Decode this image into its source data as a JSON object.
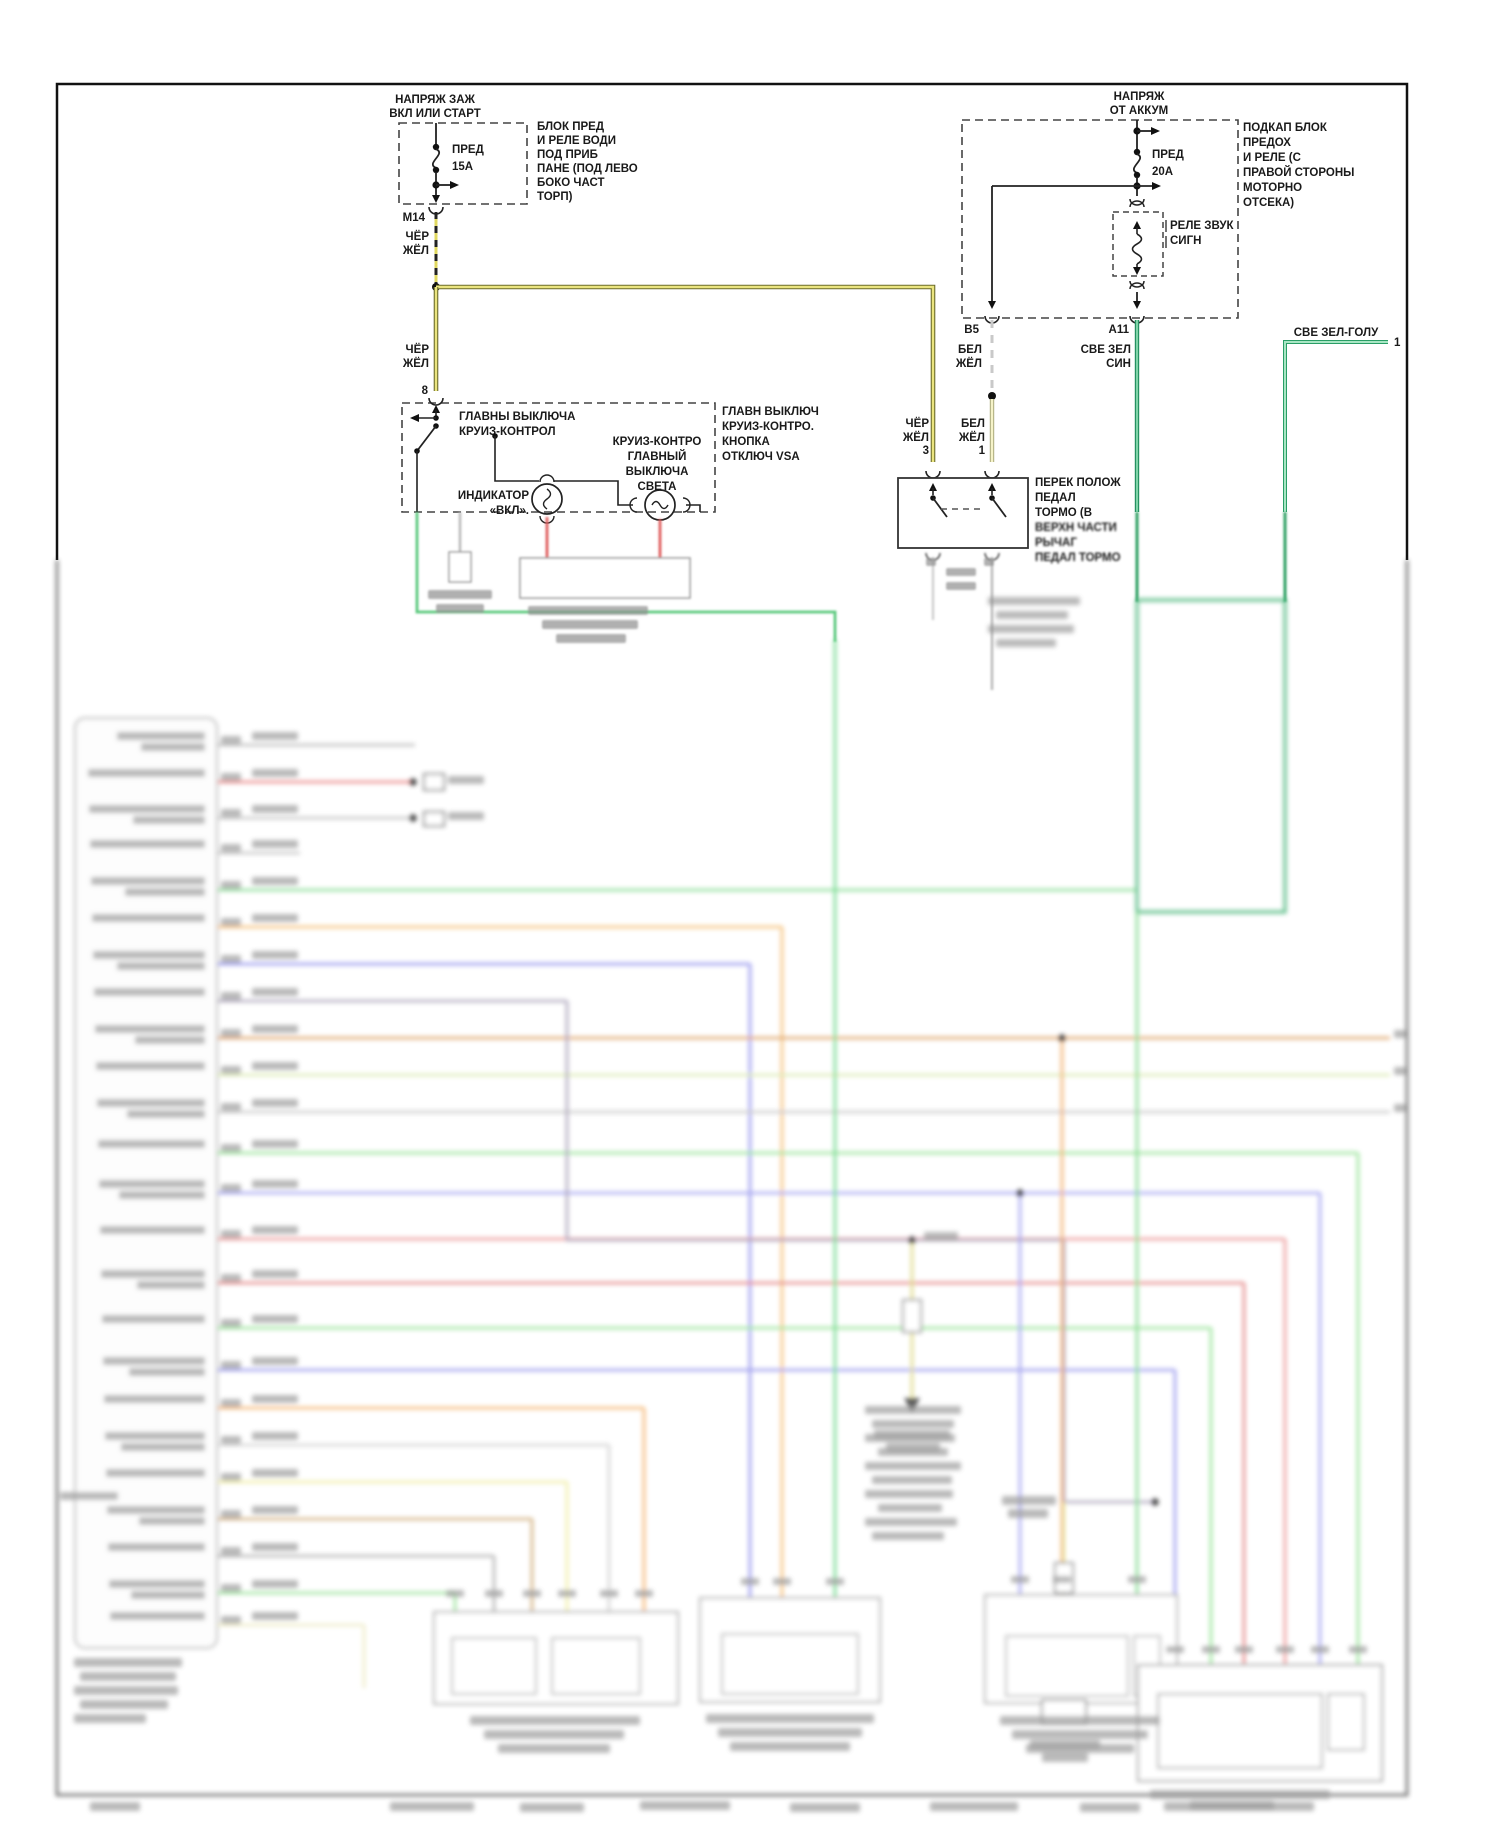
{
  "palette": {
    "line_dark": "#2b2b2b",
    "cher_zhel_edge": "#6b6b2a",
    "cher_zhel_core": "#eae47f",
    "bel_zhel_edge": "#a8a87a",
    "bel_zhel_core": "#f6f3c8",
    "green_edge": "#1c8a5a",
    "green_core": "#7fd4a8",
    "blob_gray": "#8f8f8f"
  },
  "header": {
    "ignition": {
      "l1": "НАПРЯЖ ЗАЖ",
      "l2": "ВКЛ ИЛИ СТАРТ"
    },
    "battery": {
      "l1": "НАПРЯЖ",
      "l2": "ОТ АККУМ"
    }
  },
  "fuse_box_left": {
    "fuse": "ПРЕД",
    "rating": "15A",
    "desc": [
      "БЛОК ПРЕД",
      "И РЕЛЕ ВОДИ",
      "ПОД ПРИБ",
      "ПАНЕ (ПОД ЛЕВО",
      "БОКО ЧАСТ",
      "ТОРП)"
    ],
    "connector": "М14"
  },
  "fuse_box_right": {
    "fuse": "ПРЕД",
    "rating": "20A",
    "desc": [
      "ПОДКАП БЛОК",
      "ПРЕДОХ",
      "И РЕЛЕ (С",
      "ПРАВОЙ СТОРОНЫ",
      "МОТОРНО",
      "ОТСЕКА)"
    ],
    "relay1": "РЕЛЕ ЗВУК",
    "relay2": "СИГН",
    "b5": "B5",
    "a11": "A11"
  },
  "wire_labels": {
    "cher": "ЧЁР",
    "zhel": "ЖЁЛ",
    "bel": "БЕЛ",
    "sve_zel": "СВЕ ЗЕЛ",
    "sin": "СИН",
    "sve_zel_golu": "СВЕ ЗЕЛ-ГОЛУ",
    "pin8": "8",
    "pin3": "3",
    "pin1": "1",
    "pin1_right": "1"
  },
  "cruise_switch": {
    "title1": "ГЛАВНЫ ВЫКЛЮЧА",
    "title2": "КРУИЗ-КОНТРОЛ",
    "ind1": "ИНДИКАТОР",
    "ind2": "«ВКЛ».",
    "lamp1": "КРУИЗ-КОНТРО",
    "lamp2": "ГЛАВНЫЙ",
    "lamp3": "ВЫКЛЮЧА",
    "lamp4": "СВЕТА",
    "note1": "ГЛАВН ВЫКЛЮЧ",
    "note2": "КРУИЗ-КОНТРО.",
    "note3": "КНОПКА",
    "note4": "ОТКЛЮЧ VSA"
  },
  "pedal_switch": {
    "d1": "ПЕРЕК ПОЛОЖ",
    "d2": "ПЕДАЛ",
    "d3": "ТОРМО (В",
    "d4": "ВЕРХН ЧАСТИ",
    "d5": "РЫЧАГ",
    "d6": "ПЕДАЛ ТОРМО"
  },
  "blur_section": {
    "note": "lower half of scan is out of focus; text illegible",
    "block": {
      "x": 75,
      "y": 718,
      "w": 142,
      "h": 930
    },
    "rows": [
      {
        "y": 745,
        "c": "#b5b5b5",
        "x2": 415
      },
      {
        "y": 782,
        "c": "#e87a7a",
        "x2": 413,
        "dot": 1
      },
      {
        "y": 818,
        "c": "#bdbdbd",
        "x2": 413,
        "dot": 1
      },
      {
        "y": 853,
        "c": "#bdbdbd",
        "x2": 300
      },
      {
        "y": 890,
        "c": "#7ed98c",
        "x2": 1136
      },
      {
        "y": 927,
        "c": "#f4b96a",
        "x2": 782,
        "drop": 1598
      },
      {
        "y": 964,
        "c": "#8b8bec",
        "x2": 750,
        "drop": 1598
      },
      {
        "y": 1001,
        "c": "#a49cb4",
        "x2": 567
      },
      {
        "y": 1038,
        "c": "#dc9a58",
        "x2": 1390,
        "stub": 1
      },
      {
        "y": 1075,
        "c": "#d8e8aa",
        "x2": 1390,
        "stub": 1
      },
      {
        "y": 1112,
        "c": "#c4c4c4",
        "x2": 1390,
        "stub": 1
      },
      {
        "y": 1153,
        "c": "#8ee08e",
        "x2": 1358,
        "drop": 1665
      },
      {
        "y": 1193,
        "c": "#9c9cef",
        "x2": 1320,
        "drop": 1665
      },
      {
        "y": 1239,
        "c": "#ea8d8d",
        "x2": 1285,
        "drop": 1665
      },
      {
        "y": 1283,
        "c": "#e27a7a",
        "x2": 1244,
        "drop": 1665
      },
      {
        "y": 1328,
        "c": "#8ee08e",
        "x2": 1211,
        "drop": 1665
      },
      {
        "y": 1370,
        "c": "#9292ec",
        "x2": 1175,
        "drop": 1665
      },
      {
        "y": 1408,
        "c": "#f4ae64",
        "x2": 644,
        "drop": 1612
      },
      {
        "y": 1445,
        "c": "#cfcfcf",
        "x2": 609,
        "drop": 1612
      },
      {
        "y": 1482,
        "c": "#efec9c",
        "x2": 567,
        "drop": 1612
      },
      {
        "y": 1519,
        "c": "#cda772",
        "x2": 532,
        "drop": 1612
      },
      {
        "y": 1556,
        "c": "#ababab",
        "x2": 494,
        "drop": 1612
      },
      {
        "y": 1593,
        "c": "#90e090",
        "x2": 455,
        "drop": 1612
      },
      {
        "y": 1625,
        "c": "#ece9c0",
        "x2": 364,
        "drop": 1688
      }
    ],
    "specials": [
      {
        "c": "#a49cb4",
        "w": 2.6,
        "pts": [
          [
            567,
            1001
          ],
          [
            567,
            1240
          ],
          [
            1064,
            1240
          ],
          [
            1064,
            1502
          ],
          [
            1155,
            1502
          ]
        ]
      },
      {
        "c": "#6cd98a",
        "w": 2.8,
        "pts": [
          [
            835,
            640
          ],
          [
            835,
            1598
          ]
        ]
      },
      {
        "c": "#4db87e",
        "w": 3.2,
        "pts": [
          [
            1137,
            600
          ],
          [
            1285,
            600
          ],
          [
            1285,
            912
          ],
          [
            1137,
            912
          ],
          [
            1137,
            600
          ]
        ]
      },
      {
        "c": "#7ed98c",
        "w": 2.8,
        "pts": [
          [
            1137,
            912
          ],
          [
            1137,
            1595
          ]
        ]
      },
      {
        "c": "#9c9cef",
        "w": 2.6,
        "pts": [
          [
            1020,
            1193
          ],
          [
            1020,
            1595
          ]
        ]
      },
      {
        "c": "#f0a860",
        "w": 2.6,
        "pts": [
          [
            1062,
            1038
          ],
          [
            1062,
            1595
          ]
        ]
      },
      {
        "c": "#d9d37a",
        "w": 2.6,
        "pts": [
          [
            912,
            1240
          ],
          [
            912,
            1300
          ]
        ]
      },
      {
        "c": "#d9d37a",
        "w": 2.6,
        "pts": [
          [
            912,
            1332
          ],
          [
            912,
            1398
          ]
        ]
      },
      {
        "c": "#e6e29a",
        "w": 2.6,
        "pts": [
          [
            1064,
            1502
          ],
          [
            1064,
            1563
          ]
        ]
      },
      {
        "c": "#e6e29a",
        "w": 2.6,
        "pts": [
          [
            1064,
            1593
          ],
          [
            1064,
            1662
          ]
        ]
      },
      {
        "c": "#777777",
        "w": 1.6,
        "pts": [
          [
            1064,
            1662
          ],
          [
            1074,
            1680
          ],
          [
            1064,
            1698
          ],
          [
            1054,
            1680
          ],
          [
            1064,
            1662
          ]
        ]
      },
      {
        "c": "#555555",
        "w": 2.5,
        "pts": [
          [
            57,
            560
          ],
          [
            57,
            1795
          ],
          [
            1407,
            1795
          ],
          [
            1407,
            560
          ]
        ]
      }
    ],
    "dots": [
      [
        912,
        1240
      ],
      [
        1155,
        1502
      ],
      [
        1020,
        1193
      ],
      [
        1062,
        1038
      ],
      [
        413,
        782
      ],
      [
        413,
        818
      ]
    ],
    "rects": [
      {
        "x": 434,
        "y": 1612,
        "w": 244,
        "h": 92,
        "s": "#999999"
      },
      {
        "x": 452,
        "y": 1638,
        "w": 84,
        "h": 56,
        "s": "#aaaaaa"
      },
      {
        "x": 552,
        "y": 1638,
        "w": 88,
        "h": 56,
        "s": "#aaaaaa"
      },
      {
        "x": 700,
        "y": 1598,
        "w": 180,
        "h": 104,
        "s": "#999999"
      },
      {
        "x": 722,
        "y": 1634,
        "w": 136,
        "h": 60,
        "s": "#aaaaaa"
      },
      {
        "x": 985,
        "y": 1595,
        "w": 192,
        "h": 108,
        "s": "#999999"
      },
      {
        "x": 1006,
        "y": 1636,
        "w": 122,
        "h": 60,
        "s": "#aaaaaa"
      },
      {
        "x": 1134,
        "y": 1636,
        "w": 26,
        "h": 60,
        "s": "#aaaaaa"
      },
      {
        "x": 1138,
        "y": 1665,
        "w": 244,
        "h": 116,
        "s": "#888888"
      },
      {
        "x": 1158,
        "y": 1694,
        "w": 164,
        "h": 74,
        "s": "#999999"
      },
      {
        "x": 1328,
        "y": 1694,
        "w": 36,
        "h": 56,
        "s": "#999999"
      },
      {
        "x": 903,
        "y": 1300,
        "w": 18,
        "h": 32,
        "s": "#777777"
      },
      {
        "x": 1055,
        "y": 1563,
        "w": 18,
        "h": 30,
        "s": "#777777"
      },
      {
        "x": 1042,
        "y": 1700,
        "w": 44,
        "h": 24,
        "s": "#777777"
      },
      {
        "x": 424,
        "y": 774,
        "w": 20,
        "h": 16,
        "s": "#555555"
      },
      {
        "x": 424,
        "y": 812,
        "w": 20,
        "h": 14,
        "s": "#555555"
      }
    ],
    "tris": [
      [
        904,
        1398,
        920,
        1398,
        912,
        1413
      ]
    ],
    "blobs": [
      [
        865,
        1406,
        96,
        8
      ],
      [
        872,
        1420,
        82,
        8
      ],
      [
        865,
        1434,
        90,
        8
      ],
      [
        878,
        1448,
        70,
        8
      ],
      [
        865,
        1462,
        96,
        8
      ],
      [
        872,
        1476,
        80,
        8
      ],
      [
        865,
        1490,
        88,
        8
      ],
      [
        878,
        1504,
        64,
        8
      ],
      [
        865,
        1518,
        92,
        8
      ],
      [
        872,
        1532,
        72,
        8
      ],
      [
        988,
        597,
        92,
        8
      ],
      [
        996,
        611,
        72,
        8
      ],
      [
        988,
        625,
        86,
        8
      ],
      [
        996,
        639,
        60,
        8
      ],
      [
        74,
        1658,
        108,
        9
      ],
      [
        80,
        1672,
        96,
        9
      ],
      [
        74,
        1686,
        104,
        9
      ],
      [
        80,
        1700,
        88,
        9
      ],
      [
        74,
        1714,
        72,
        9
      ],
      [
        470,
        1716,
        170,
        9
      ],
      [
        484,
        1730,
        140,
        9
      ],
      [
        498,
        1744,
        112,
        9
      ],
      [
        706,
        1714,
        168,
        9
      ],
      [
        718,
        1728,
        144,
        9
      ],
      [
        730,
        1742,
        120,
        9
      ],
      [
        1000,
        1716,
        160,
        9
      ],
      [
        1012,
        1730,
        136,
        9
      ],
      [
        1026,
        1744,
        108,
        9
      ],
      [
        1150,
        1790,
        180,
        9
      ],
      [
        1164,
        1802,
        150,
        9
      ],
      [
        924,
        1232,
        34,
        9
      ],
      [
        874,
        1430,
        76,
        9
      ],
      [
        886,
        1443,
        54,
        9
      ],
      [
        1002,
        1496,
        54,
        9
      ],
      [
        1008,
        1509,
        40,
        9
      ],
      [
        1030,
        1740,
        70,
        9
      ],
      [
        1042,
        1753,
        46,
        9
      ],
      [
        448,
        776,
        36,
        8
      ],
      [
        448,
        812,
        36,
        8
      ],
      [
        390,
        1802,
        84,
        9
      ],
      [
        520,
        1803,
        64,
        9
      ],
      [
        640,
        1801,
        90,
        9
      ],
      [
        790,
        1803,
        70,
        9
      ],
      [
        930,
        1802,
        88,
        9
      ],
      [
        1080,
        1803,
        60,
        9
      ],
      [
        1190,
        1801,
        84,
        9
      ],
      [
        90,
        1802,
        50,
        9
      ],
      [
        60,
        1492,
        58,
        8
      ],
      [
        446,
        1590,
        18,
        7
      ],
      [
        485,
        1590,
        18,
        7
      ],
      [
        523,
        1590,
        18,
        7
      ],
      [
        558,
        1590,
        18,
        7
      ],
      [
        600,
        1590,
        18,
        7
      ],
      [
        635,
        1590,
        18,
        7
      ],
      [
        741,
        1578,
        18,
        7
      ],
      [
        773,
        1578,
        18,
        7
      ],
      [
        826,
        1578,
        18,
        7
      ],
      [
        1011,
        1576,
        18,
        7
      ],
      [
        1053,
        1576,
        18,
        7
      ],
      [
        1128,
        1576,
        18,
        7
      ],
      [
        1166,
        1646,
        18,
        7
      ],
      [
        1202,
        1646,
        18,
        7
      ],
      [
        1235,
        1646,
        18,
        7
      ],
      [
        1276,
        1646,
        18,
        7
      ],
      [
        1311,
        1646,
        18,
        7
      ],
      [
        1349,
        1646,
        18,
        7
      ]
    ],
    "light_blobs": [
      [
        528,
        606,
        120,
        9
      ],
      [
        542,
        620,
        96,
        9
      ],
      [
        556,
        634,
        70,
        9
      ],
      [
        428,
        590,
        64,
        9
      ],
      [
        436,
        604,
        48,
        9
      ],
      [
        926,
        558,
        10,
        8
      ],
      [
        984,
        558,
        10,
        8
      ],
      [
        946,
        568,
        30,
        8
      ],
      [
        946,
        582,
        30,
        8
      ]
    ]
  }
}
